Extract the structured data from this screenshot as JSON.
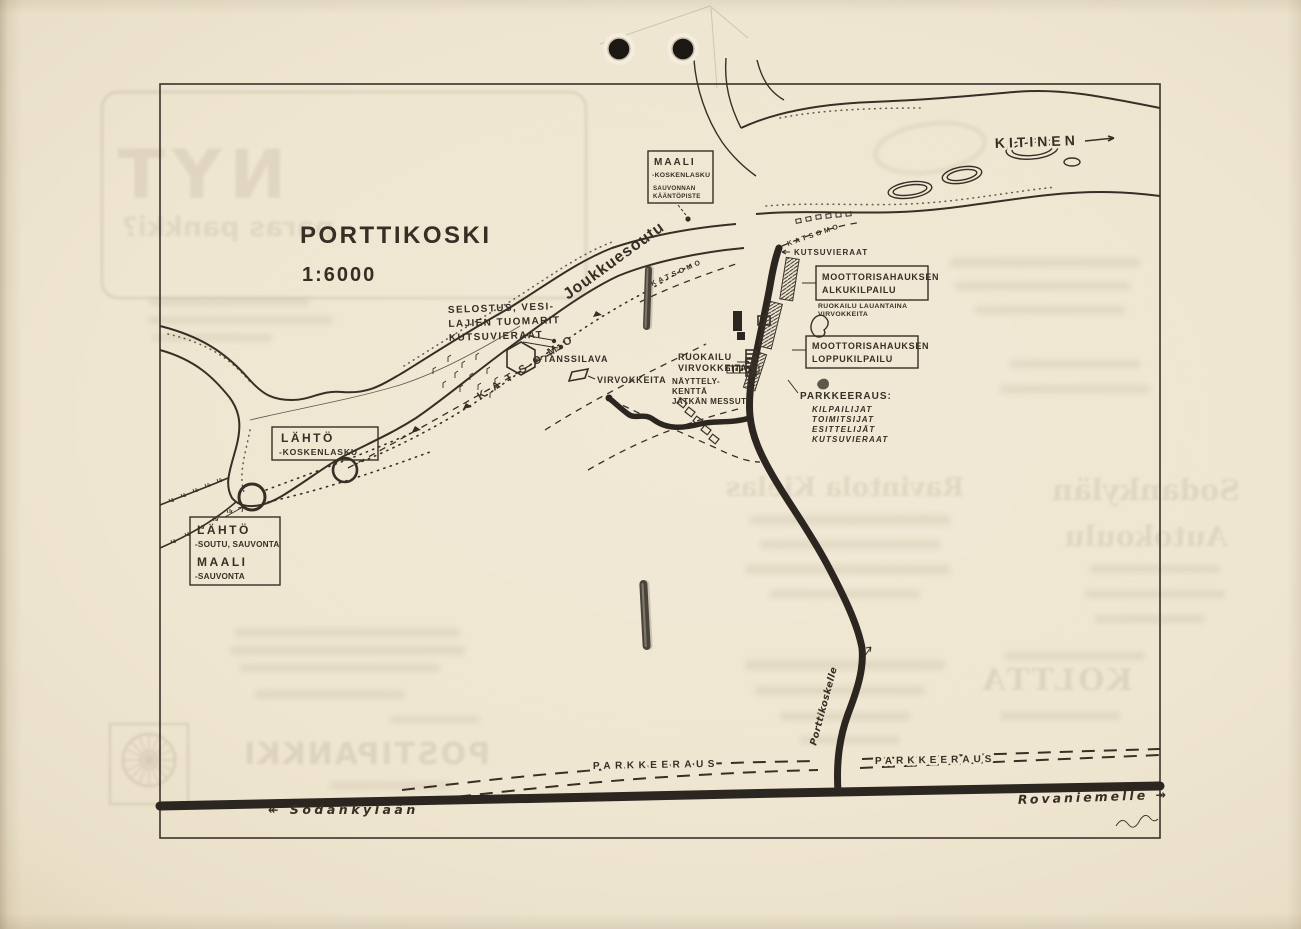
{
  "map": {
    "title": "PORTTIKOSKI",
    "scale": "1:6000",
    "kitinen": "KITINEN",
    "joukkuesoutu": "Joukkuesoutu",
    "katsomo": "KATSOMO",
    "kutsuvieraat": "KUTSUVIERAAT",
    "maali": {
      "l1": "MAALI",
      "l2": "-KOSKENLASKU",
      "l3": "SAUVONNAN",
      "l4": "KÄÄNTÖPISTE"
    },
    "alku": {
      "l1": "MOOTTORISAHAUKSEN",
      "l2": "ALKUKILPAILU"
    },
    "ruok_lauantaina": {
      "l1": "RUOKAILU LAUANTAINA",
      "l2": "VIRVOKKEITA"
    },
    "loppu": {
      "l1": "MOOTTORISAHAUKSEN",
      "l2": "LOPPUKILPAILU"
    },
    "selostus": {
      "l1": "SELOSTUS, VESI-",
      "l2": "LAJIEN TUOMARIT",
      "l3": "KUTSUVIERAAT"
    },
    "tanssilava": "TANSSILAVA",
    "ruokailu": {
      "l1": "RUOKAILU",
      "l2": "VIRVOKKEITA"
    },
    "virvokkeita": "VIRVOKKEITA",
    "nayttely": {
      "l1": "NÄYTTELY-",
      "l2": "KENTTÄ",
      "l3": "JÄTKÄN MESSUT"
    },
    "park_note": {
      "t": "PARKKEERAUS:",
      "i1": "KILPAILIJAT",
      "i2": "TOIMITSIJAT",
      "i3": "ESITTELIJÄT",
      "i4": "KUTSUVIERAAT"
    },
    "lahto1": {
      "l1": "LÄHTÖ",
      "l2": "-KOSKENLASKU"
    },
    "lahto2": {
      "l1": "LÄHTÖ",
      "l2": "-SOUTU, SAUVONTA",
      "l3": "MAALI",
      "l4": "-SAUVONTA"
    },
    "porttikoskelle": "Porttikoskelle",
    "park_left": "PARKKEERAUS",
    "park_right": "PARKKEERAUS",
    "sodankylaan": "↞ Sodankylään",
    "rovaniemelle": "Rovaniemelle ↠"
  },
  "bleed": {
    "nyt": "NYT",
    "paras": "paras pankki?",
    "ravintola": "Ravintola Kielas",
    "sodankylan": "Sodankylän",
    "autokoulu": "Autokoulu",
    "koltta": "KOLTTA",
    "postipankki": "POSTIPANKKI"
  }
}
